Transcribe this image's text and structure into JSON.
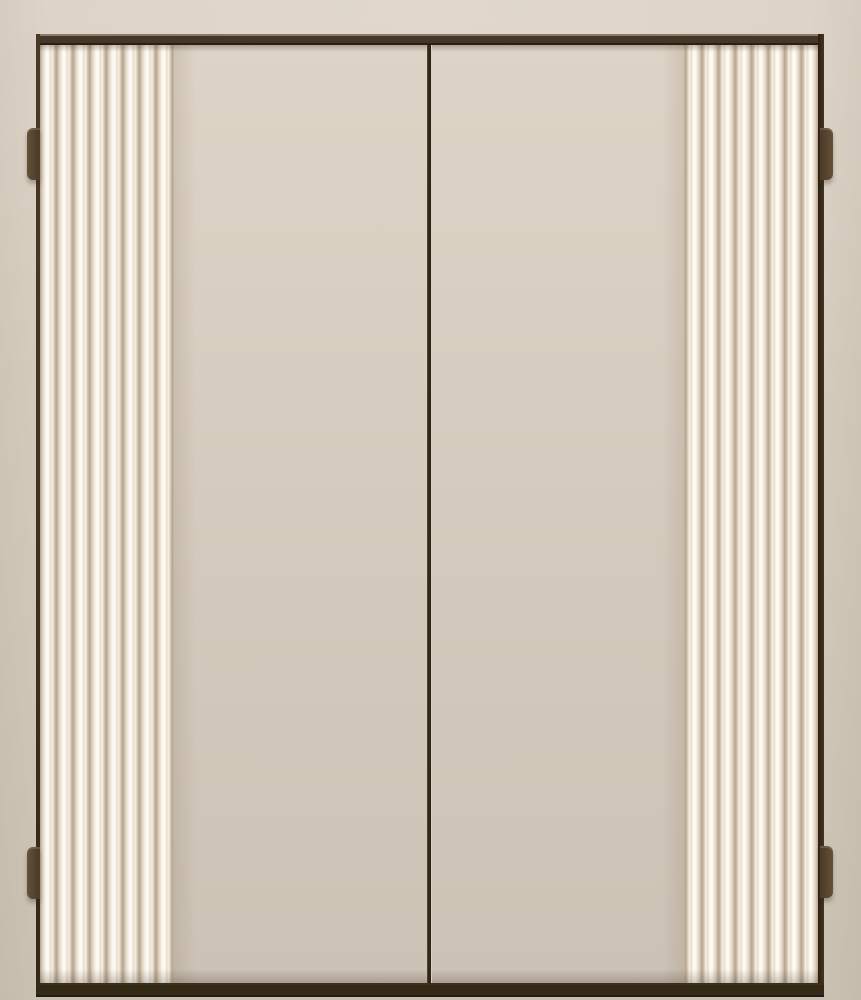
{
  "scene": {
    "subject": "closed double cabinet doors with fluted outer panels, dark bronze frame, center seam and four exterior hinges on a beige wall",
    "door_count": 2,
    "hinge_count": 4,
    "reeds_per_fluted_panel": 8,
    "colors": {
      "wall_top": "#dcd2c5",
      "wall_mid": "#d6ccbe",
      "wall_bottom": "#cdc3b4",
      "frame_highlight": "#8c7b63",
      "frame_dark": "#46362a",
      "frame_edge": "#2c2013",
      "stile_left": "#43331f",
      "stile_right": "#45341f",
      "rail_bottom": "#342817",
      "floor_line": "#c5beb4",
      "door_top": "#ddd3c6",
      "door_mid": "#d3c9bc",
      "door_bottom": "#ccc2b5",
      "seam": "#32261a",
      "seam_highlight": "#d9cfc2",
      "flute_groove": "#b5a48f",
      "flute_shade": "#cfc1ae",
      "flute_mid": "#e7decd",
      "flute_ridge": "#f6f0e4",
      "flute_light": "#fdfaf3",
      "hinge_light": "#63513a",
      "hinge_dark": "#4e3d29"
    }
  }
}
